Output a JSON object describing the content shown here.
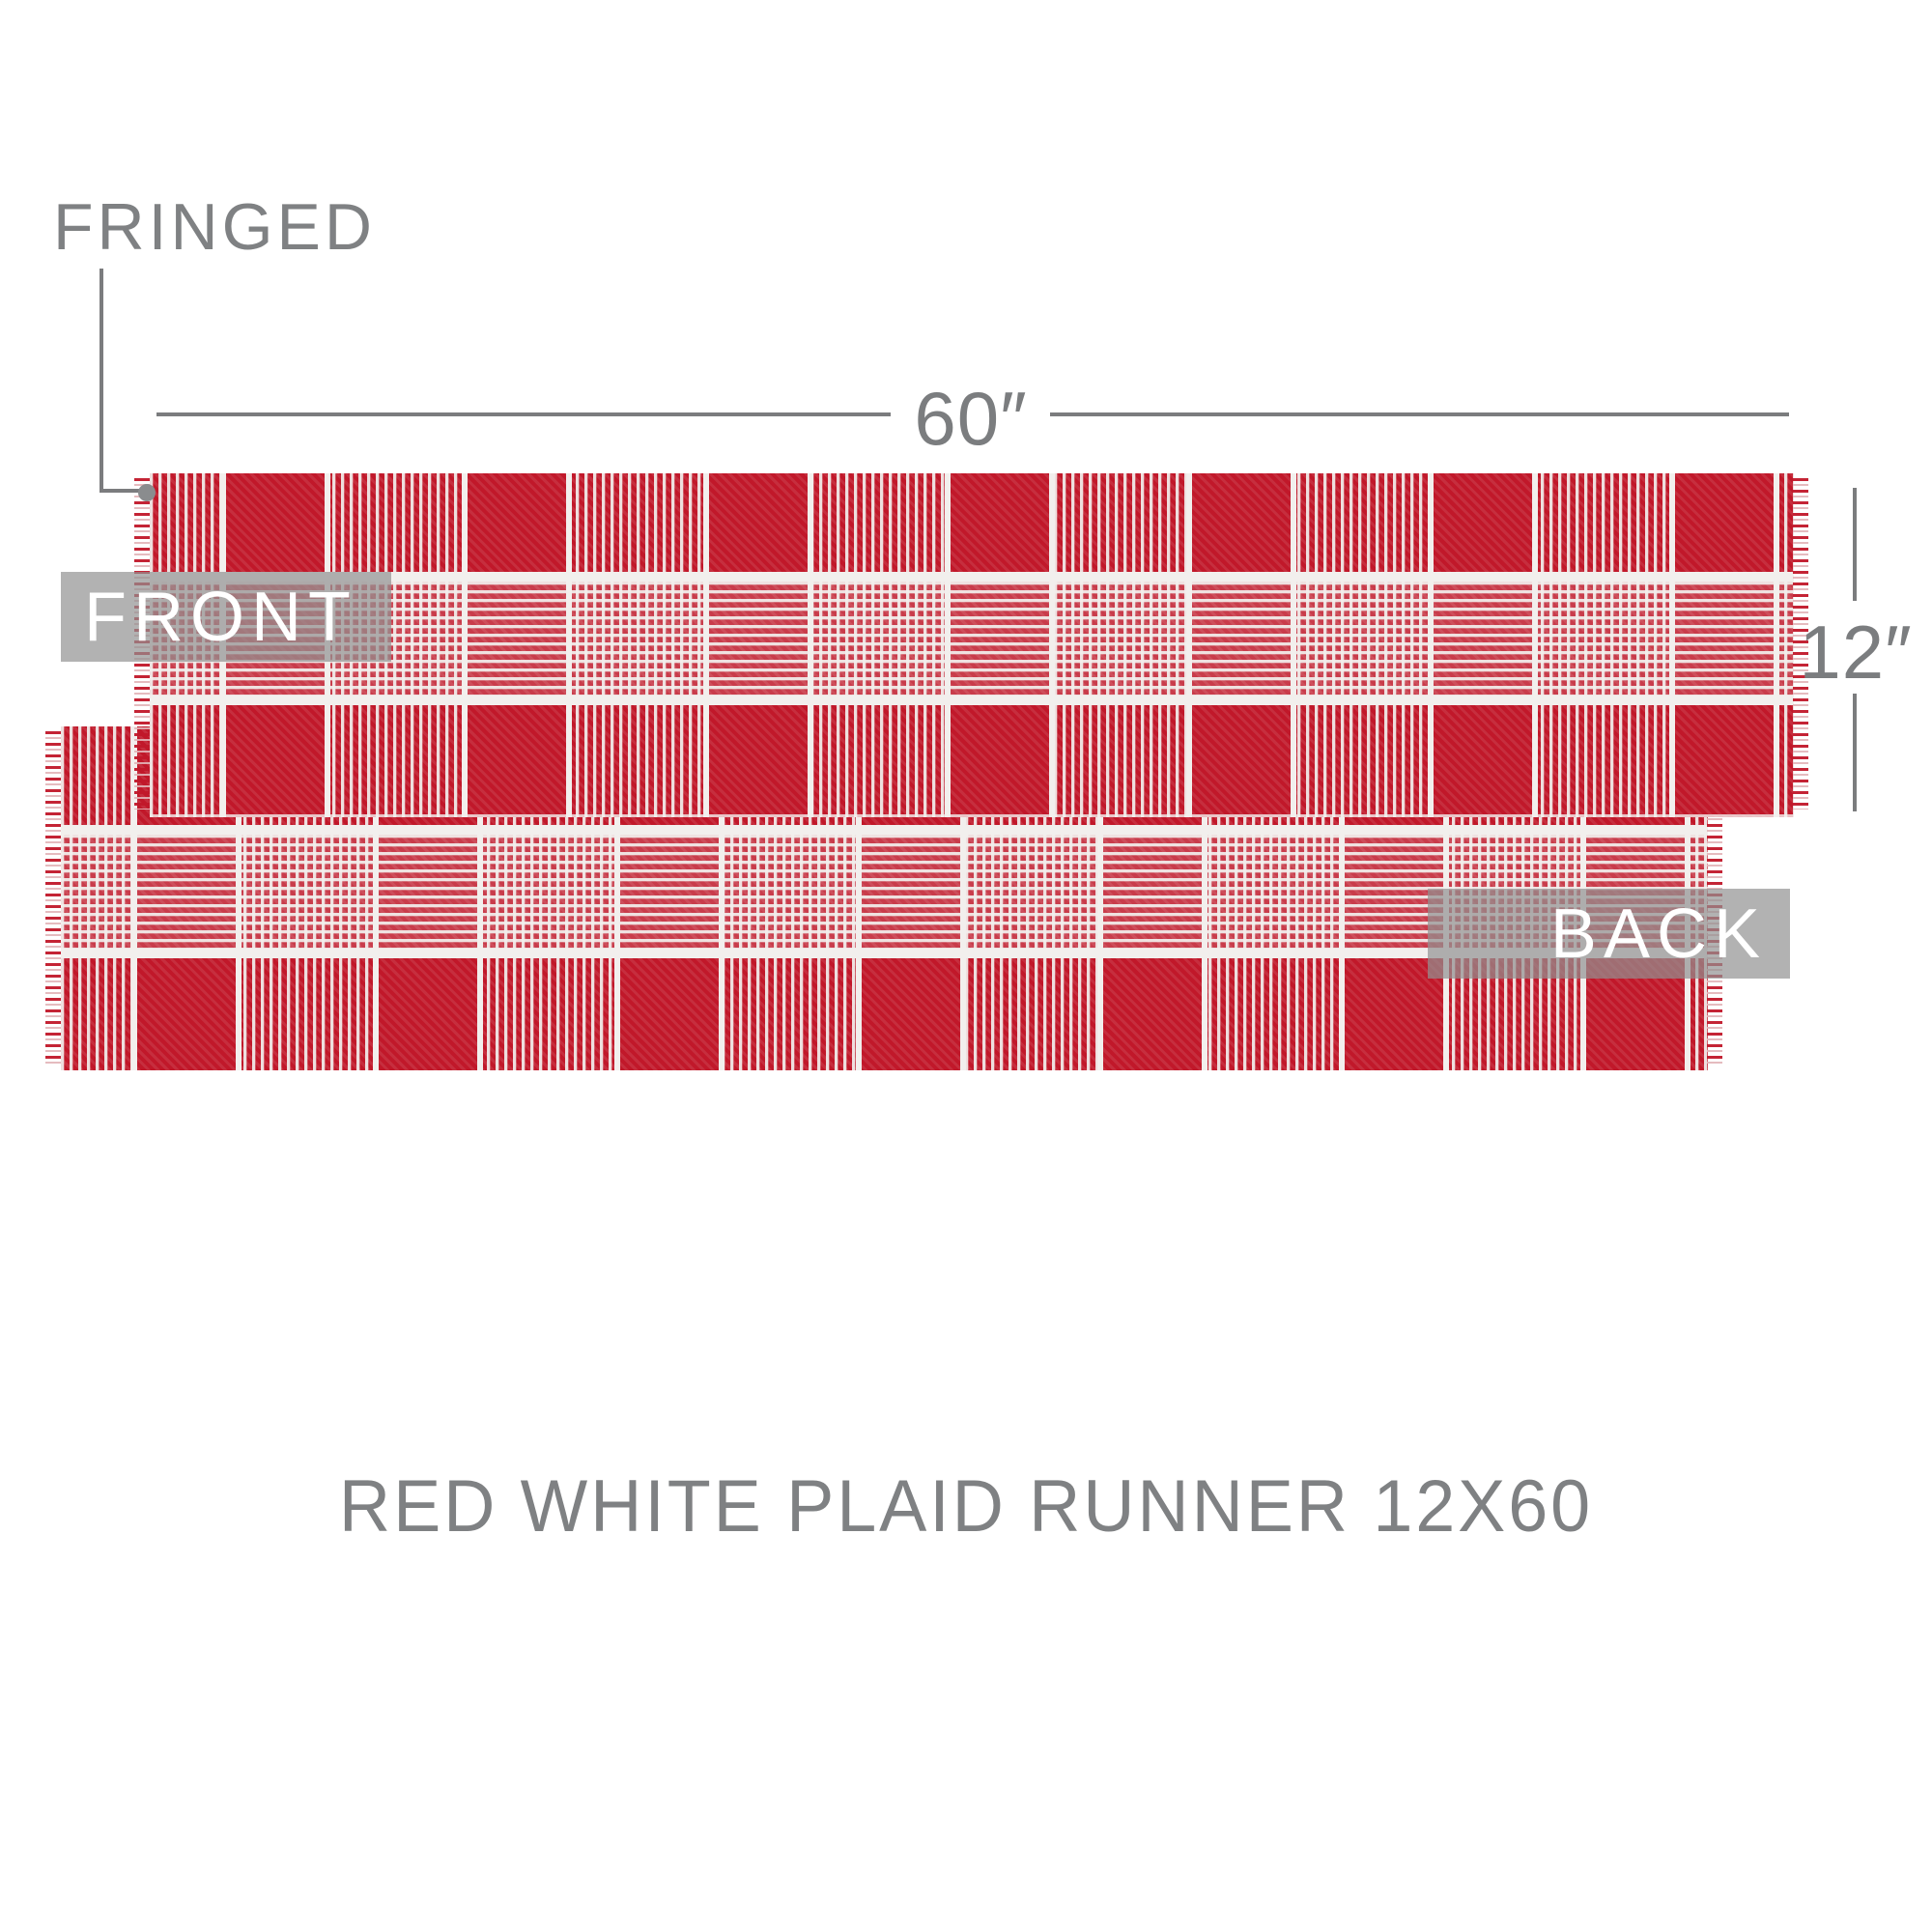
{
  "annotations": {
    "fringed": "FRINGED",
    "width": "60″",
    "height": "12″"
  },
  "views": {
    "front": "FRONT",
    "back": "BACK"
  },
  "caption": "RED WHITE PLAID RUNNER 12X60",
  "product": {
    "width_inches": 60,
    "height_inches": 12
  },
  "colors": {
    "fabric_red": "#c1182a",
    "thread_white": "#f2efed",
    "annotation_gray": "#7f8183",
    "dimension_line_gray": "#7b7c7e",
    "pointer_dot_gray": "#8a8c8e",
    "label_overlay_gray": "rgba(145,145,146,0.70)",
    "label_text_white": "#ffffff",
    "background_white": "#ffffff"
  }
}
